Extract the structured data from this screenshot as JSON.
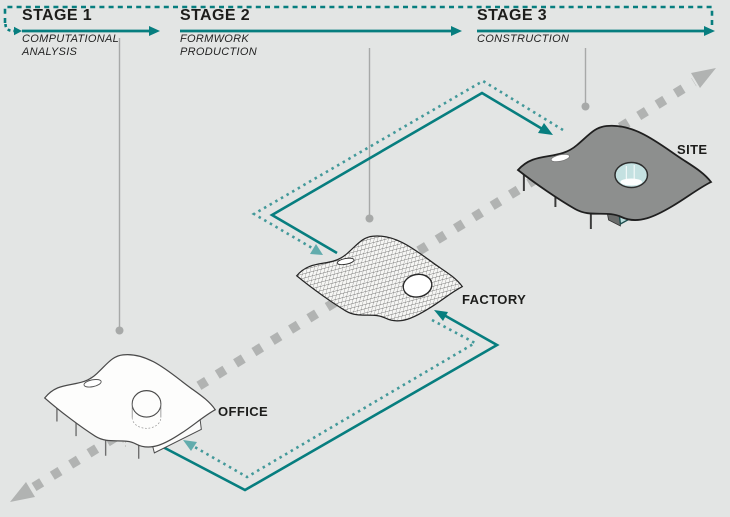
{
  "diagram": {
    "stages": [
      {
        "label": "STAGE 1",
        "subtitle_line1": "COMPUTATIONAL",
        "subtitle_line2": "ANALYSIS"
      },
      {
        "label": "STAGE 2",
        "subtitle_line1": "FORMWORK",
        "subtitle_line2": "PRODUCTION"
      },
      {
        "label": "STAGE 3",
        "subtitle_line1": "CONSTRUCTION",
        "subtitle_line2": ""
      }
    ],
    "locations": [
      {
        "label": "OFFICE"
      },
      {
        "label": "FACTORY"
      },
      {
        "label": "SITE"
      }
    ],
    "flow": {
      "forward_links": [
        "OFFICE to FACTORY",
        "FACTORY to SITE"
      ],
      "feedback_links": [
        "FACTORY to OFFICE",
        "SITE to FACTORY",
        "STAGE 3 back to STAGE 1"
      ]
    }
  },
  "colors": {
    "bg": "#e3e5e4",
    "teal": "#077e7f",
    "teal_dot": "#43999a",
    "teal_arrow_light": "#62acad",
    "gray_dash": "#b1b3b2",
    "callout": "#a7a9a8",
    "ink": "#1d1d1b",
    "roof_gray": "#8d8f8e",
    "glass": "#c4e1e1",
    "box_teal": "#b9dcdb"
  }
}
